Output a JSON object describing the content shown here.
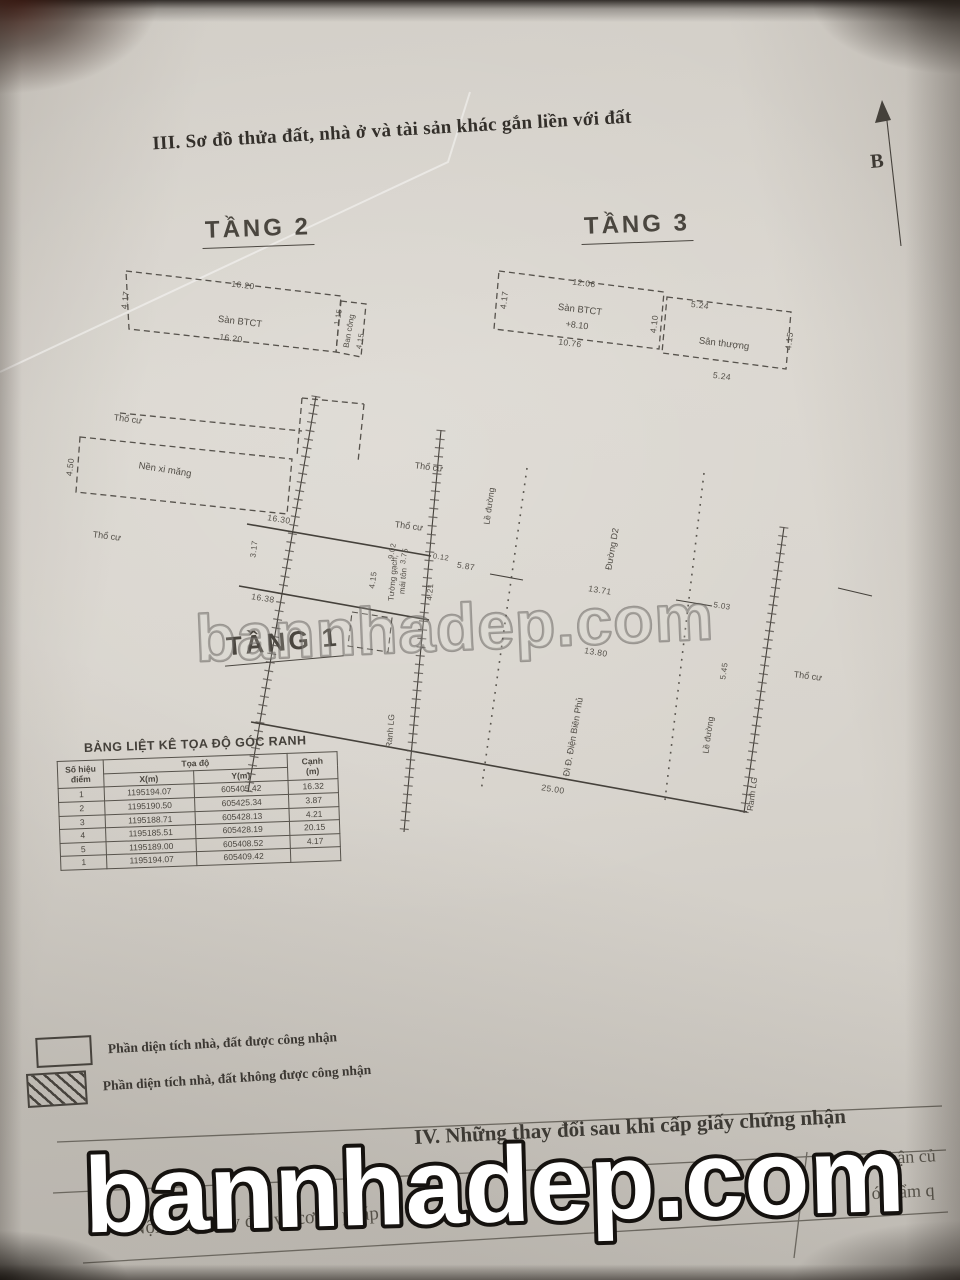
{
  "watermark": "bannhadep.com",
  "title": "III. Sơ đồ thửa đất, nhà ở và tài sản khác gắn liền với đất",
  "north_label": "B",
  "floor2": {
    "title": "TẦNG 2",
    "slab": "Sàn BTCT",
    "dim_top": "16.20",
    "dim_bottom": "16.20",
    "dim_left": "4.17",
    "balcony": "Ban công",
    "balcony_d1": "1.15",
    "balcony_d2": "4.15"
  },
  "floor3": {
    "title": "TẦNG 3",
    "slab": "Sàn BTCT",
    "elev": "+8.10",
    "terrace": "Sân thượng",
    "dim_top": "12.06",
    "dim_bottom": "10.76",
    "dim_left": "4.17",
    "dim_mid": "4.10",
    "ter_top": "5.24",
    "ter_bottom": "5.24",
    "ter_right": "4.15"
  },
  "floor1": {
    "title": "TẦNG 1",
    "tho_cu": "Thổ cư",
    "nen_xi_mang": "Nền xi măng",
    "wall_line1": "Tường gạch,",
    "wall_line2": "mái tôn",
    "ranh_lg": "Ranh LG",
    "le_duong": "Lề đường",
    "duong_d2": "Đường D2",
    "di_dbp": "Đi Đ. Điện Biên Phủ",
    "d_450": "4.50",
    "d_317": "3.17",
    "d_1630": "16.30",
    "d_1638": "16.38",
    "d_902": "9.02",
    "d_375": "3.75",
    "d_012": "0.12",
    "d_415": "4.15",
    "d_421": "4.21",
    "d_587": "5.87",
    "d_1371": "13.71",
    "d_1380": "13.80",
    "d_503": "5.03",
    "d_545": "5.45",
    "d_2500": "25.00"
  },
  "table": {
    "title": "BẢNG LIỆT KÊ TỌA ĐỘ GÓC RANH",
    "h_point_1": "Số hiệu",
    "h_point_2": "điểm",
    "h_coord": "Tọa độ",
    "h_x": "X(m)",
    "h_y": "Y(m)",
    "h_edge_1": "Cạnh",
    "h_edge_2": "(m)",
    "rows": [
      [
        "1",
        "1195194.07",
        "605405.42",
        "16.32"
      ],
      [
        "2",
        "1195190.50",
        "605425.34",
        "3.87"
      ],
      [
        "3",
        "1195188.71",
        "605428.13",
        "4.21"
      ],
      [
        "4",
        "1195185.51",
        "605428.19",
        "20.15"
      ],
      [
        "5",
        "1195189.00",
        "605408.52",
        "4.17"
      ],
      [
        "1",
        "1195194.07",
        "605409.42",
        ""
      ]
    ]
  },
  "legend": {
    "recognized": "Phần diện tích nhà, đất được công nhận",
    "not_recognized": "Phần diện tích nhà, đất không được công nhận"
  },
  "section4": {
    "title": "IV. Những thay đổi sau khi cấp giấy chứng nhận",
    "left_header": "Nội dung thay đổi và cơ sở pháp lý",
    "right_frag1": "hận củ",
    "right_frag2": "ó thẩm q"
  }
}
